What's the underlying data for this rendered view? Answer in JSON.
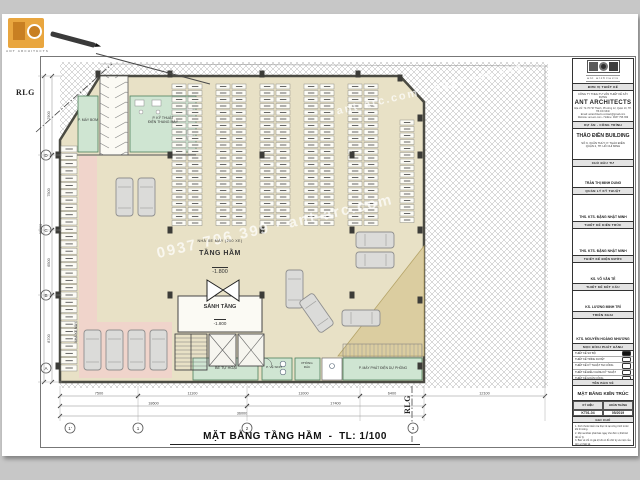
{
  "plan": {
    "title": "MẶT BẰNG TẦNG HẦM",
    "title_sep": "-",
    "scale": "TL: 1/100",
    "watermark": "0937 796 399 · ant-arc.com",
    "watermark2": "ant-arc.com · 0937 796 399",
    "rlg": "RLG",
    "labels": {
      "moto_note": "NHÀ XE MÁY (200 XE)",
      "basement": "TẦNG HẦM",
      "basement_level": "-1.800",
      "lobby": "SẢNH TẦNG",
      "lobby_level": "-1.800",
      "pump": "P. MÁY BƠM",
      "elec1": "P. KỸ THUẬT",
      "elec2": "ĐIỆN THANG MÁY",
      "septic": "BỂ TỰ HOẠI",
      "wc": "P. VỆ SINH",
      "trash1": "PHÒNG",
      "trash2": "RÁC",
      "generator": "P. MÁY PHÁT ĐIỆN DỰ PHÒNG",
      "left_zone": "NHÀ XE MÁY"
    },
    "grid": {
      "bottom": [
        {
          "x": 70,
          "label": "1'"
        },
        {
          "x": 138,
          "label": "1"
        },
        {
          "x": 247,
          "label": "2"
        },
        {
          "x": 413,
          "label": "3"
        }
      ],
      "left": [
        {
          "y": 155,
          "label": "D"
        },
        {
          "y": 230,
          "label": "C"
        },
        {
          "y": 295,
          "label": "B"
        },
        {
          "y": 368,
          "label": "A"
        }
      ]
    },
    "dims": {
      "bottom": [
        {
          "y": 396,
          "x1": 60,
          "x2": 138,
          "v": "7500"
        },
        {
          "y": 396,
          "x1": 138,
          "x2": 247,
          "v": "11100"
        },
        {
          "y": 396,
          "x1": 247,
          "x2": 360,
          "v": "11000"
        },
        {
          "y": 396,
          "x1": 360,
          "x2": 424,
          "v": "6400"
        },
        {
          "y": 396,
          "x1": 424,
          "x2": 545,
          "v": "12100"
        },
        {
          "y": 406,
          "x1": 60,
          "x2": 247,
          "v": "18600"
        },
        {
          "y": 406,
          "x1": 247,
          "x2": 424,
          "v": "17400"
        },
        {
          "y": 416,
          "x1": 60,
          "x2": 424,
          "v": "36000"
        }
      ],
      "left": [
        {
          "x": 52,
          "y1": 76,
          "y2": 155,
          "v": "7900"
        },
        {
          "x": 52,
          "y1": 155,
          "y2": 230,
          "v": "7500"
        },
        {
          "x": 52,
          "y1": 230,
          "y2": 295,
          "v": "6500"
        },
        {
          "x": 52,
          "y1": 295,
          "y2": 382,
          "v": "8700"
        },
        {
          "x": 44,
          "y1": 76,
          "y2": 382,
          "v": "30600"
        }
      ]
    },
    "structure": {
      "columns": [
        [
          98,
          74
        ],
        [
          170,
          74
        ],
        [
          262,
          74
        ],
        [
          358,
          74
        ],
        [
          400,
          78
        ],
        [
          420,
          118
        ],
        [
          420,
          155
        ],
        [
          420,
          230
        ],
        [
          420,
          300
        ],
        [
          420,
          366
        ],
        [
          58,
          155
        ],
        [
          58,
          230
        ],
        [
          58,
          295
        ],
        [
          58,
          366
        ],
        [
          170,
          155
        ],
        [
          262,
          155
        ],
        [
          352,
          155
        ],
        [
          170,
          230
        ],
        [
          262,
          230
        ],
        [
          352,
          230
        ],
        [
          170,
          295
        ],
        [
          262,
          295
        ],
        [
          352,
          295
        ]
      ]
    },
    "parking": {
      "moto_cols": [
        {
          "x": 172,
          "y": 84,
          "n": 22,
          "step": 6.5,
          "w": 14,
          "h": 5
        },
        {
          "x": 188,
          "y": 84,
          "n": 22,
          "step": 6.5,
          "w": 14,
          "h": 5
        },
        {
          "x": 216,
          "y": 84,
          "n": 22,
          "step": 6.5,
          "w": 14,
          "h": 5
        },
        {
          "x": 232,
          "y": 84,
          "n": 22,
          "step": 6.5,
          "w": 14,
          "h": 5
        },
        {
          "x": 260,
          "y": 84,
          "n": 22,
          "step": 6.5,
          "w": 14,
          "h": 5
        },
        {
          "x": 276,
          "y": 84,
          "n": 22,
          "step": 6.5,
          "w": 14,
          "h": 5
        },
        {
          "x": 304,
          "y": 84,
          "n": 22,
          "step": 6.5,
          "w": 14,
          "h": 5
        },
        {
          "x": 320,
          "y": 84,
          "n": 22,
          "step": 6.5,
          "w": 14,
          "h": 5
        },
        {
          "x": 348,
          "y": 84,
          "n": 22,
          "step": 6.5,
          "w": 14,
          "h": 5
        },
        {
          "x": 364,
          "y": 84,
          "n": 22,
          "step": 6.5,
          "w": 14,
          "h": 5
        },
        {
          "x": 400,
          "y": 120,
          "n": 16,
          "step": 6.5,
          "w": 14,
          "h": 5
        },
        {
          "x": 61,
          "y": 146,
          "n": 31,
          "step": 7.3,
          "w": 16,
          "h": 6
        }
      ],
      "cars": [
        {
          "x": 116,
          "y": 178,
          "w": 17,
          "h": 38,
          "r": 0
        },
        {
          "x": 138,
          "y": 178,
          "w": 17,
          "h": 38,
          "r": 0
        },
        {
          "x": 84,
          "y": 330,
          "w": 17,
          "h": 40,
          "r": 0
        },
        {
          "x": 106,
          "y": 330,
          "w": 17,
          "h": 40,
          "r": 0
        },
        {
          "x": 128,
          "y": 330,
          "w": 17,
          "h": 40,
          "r": 0
        },
        {
          "x": 150,
          "y": 330,
          "w": 17,
          "h": 40,
          "r": 0
        },
        {
          "x": 286,
          "y": 270,
          "w": 17,
          "h": 38,
          "r": 0
        },
        {
          "x": 308,
          "y": 294,
          "w": 17,
          "h": 38,
          "r": -35
        },
        {
          "x": 356,
          "y": 232,
          "w": 38,
          "h": 16,
          "r": 0
        },
        {
          "x": 356,
          "y": 252,
          "w": 38,
          "h": 16,
          "r": 0
        },
        {
          "x": 342,
          "y": 310,
          "w": 38,
          "h": 16,
          "r": 0
        }
      ]
    }
  },
  "corner_logo": {
    "caption": "ANT ARCHITECTS"
  },
  "title_block": {
    "logo_text": "ant architects",
    "design_unit_label": "ĐƠN VỊ THIẾT KẾ",
    "company_line": "CÔNG TY TNHH TƯ VẤN THIẾT KẾ XÂY DỰNG",
    "company_name": "ANT ARCHITECTS",
    "company_addr": "Địa chỉ: 72-76 Hồ Thành, Phường 12, Quận 10, TP. Hồ Chí Minh",
    "company_email": "Email: antarchitects.contact@gmail.com",
    "company_web": "Website: ant-arc.com - Hotline: 0937 796 399",
    "project_label": "DỰ ÁN - CÔNG TRÌNH",
    "project_name": "THẢO ĐIỀN BUILDING",
    "project_addr1": "SỐ 9, XUÂN THỦY, P. THẢO ĐIỀN",
    "project_addr2": "QUẬN 2, TP. HỒ CHÍ MINH",
    "roles": [
      {
        "label": "CHỦ ĐẦU TƯ",
        "name": "TRẦN THỊ MINH DUNG"
      },
      {
        "label": "QUẢN LÝ KỸ THUẬT",
        "name": "THS. KTS. ĐẶNG NHẬT MINH"
      },
      {
        "label": "THIẾT KẾ KIẾN TRÚC",
        "name": "THS. KTS. ĐẶNG NHẬT MINH"
      },
      {
        "label": "THIẾT KẾ ĐIỆN NƯỚC",
        "name": "KS. VÕ VĂN TẾ"
      },
      {
        "label": "THIẾT KẾ KẾT CẤU",
        "name": "KS. LƯƠNG MINH TRÍ"
      },
      {
        "label": "TRIỂN KHAI",
        "name": "KTS. NGUYỄN HOÀNG NHƯƠNG"
      }
    ],
    "issue_label": "MỤC ĐÍCH PHÁT HÀNH",
    "issue_items": [
      {
        "label": "THIẾT KẾ SƠ BỘ",
        "checked": true
      },
      {
        "label": "THIẾT KẾ TRÌNH DUYỆT",
        "checked": false
      },
      {
        "label": "THIẾT KẾ KỸ THUẬT THI CÔNG",
        "checked": false
      },
      {
        "label": "THIẾT KẾ ĐIỀU CHỈNH KỸ THUẬT",
        "checked": false
      },
      {
        "label": "THIẾT KẾ HOÀN CÔNG",
        "checked": false
      }
    ],
    "drawing_name_label": "TÊN BẢN VẼ",
    "drawing_name": "MẶT BẰNG KIẾN TRÚC",
    "meta": {
      "symbol_label": "KÝ HIỆU",
      "date_label": "HOÀN THÀNH",
      "symbol_value": "KT01-04",
      "date_value": "05/2019"
    },
    "notes_label": "GHI CHÚ",
    "notes": [
      "1. Kích thước kiểm tra thực tế tại công trình trước khi thi công.",
      "2. Mọi sai khác phải báo ngay cho đơn vị thiết kế để xử lý.",
      "3. Bản vẽ chỉ có giá trị khi có đủ chữ ký và mộc của đơn vị thiết kế."
    ]
  }
}
